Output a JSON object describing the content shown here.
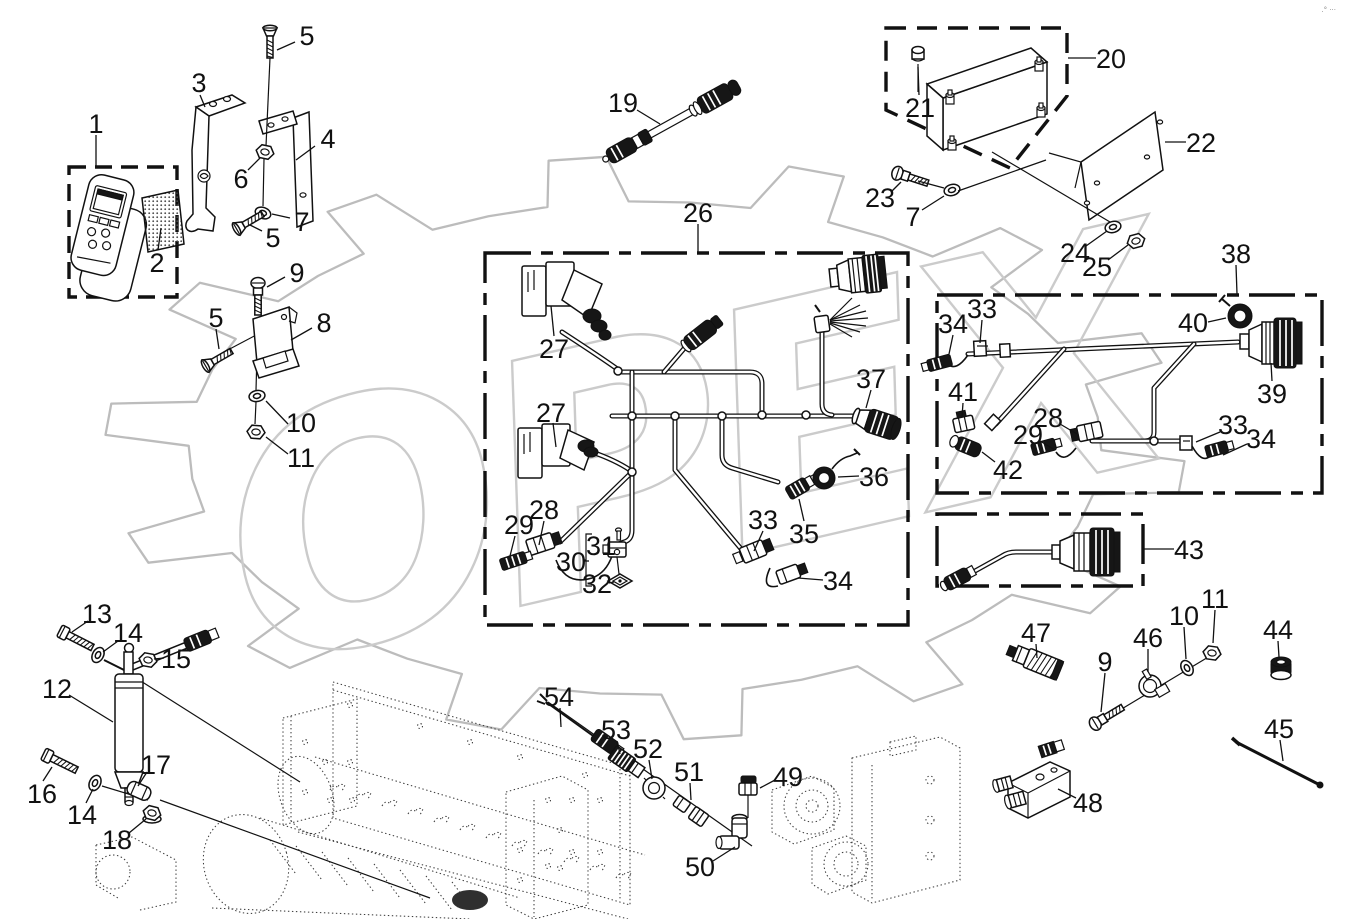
{
  "page": {
    "background": "#ffffff",
    "line_color": "#111111",
    "watermark_color": "#cbcbcb",
    "gear_color": "#bcbcbc"
  },
  "watermark": {
    "text": "OPEX"
  },
  "corner_mark": ".° ···",
  "gear": {
    "cx": 645,
    "cy": 448,
    "rx": 540,
    "ry": 292,
    "root": 0.845,
    "teeth": 14,
    "rot_rad": -0.35
  },
  "boxes": [
    {
      "name": "remote-control-box",
      "x": 69,
      "y": 167,
      "w": 108,
      "h": 130,
      "dash": "17 9"
    },
    {
      "name": "control-unit-box",
      "points": [
        [
          886,
          28
        ],
        [
          1067,
          28
        ],
        [
          1067,
          96
        ],
        [
          1010,
          168
        ],
        [
          886,
          110
        ]
      ],
      "dash": "20 11"
    },
    {
      "name": "main-harness-box",
      "x": 485,
      "y": 253,
      "w": 423,
      "h": 372,
      "dash": "46 10 12 10"
    },
    {
      "name": "harness-box-38",
      "x": 937,
      "y": 295,
      "w": 385,
      "h": 198,
      "dash": "46 10 12 10"
    },
    {
      "name": "harness-box-43",
      "x": 937,
      "y": 514,
      "w": 206,
      "h": 72,
      "dash": "40 10 12 10"
    }
  ],
  "callouts": [
    {
      "t": "1",
      "x": 96,
      "y": 123,
      "leader": [
        [
          96,
          135
        ],
        [
          96,
          166
        ]
      ]
    },
    {
      "t": "2",
      "x": 157,
      "y": 262,
      "leader": [
        [
          158,
          250
        ],
        [
          161,
          228
        ]
      ]
    },
    {
      "t": "3",
      "x": 199,
      "y": 82,
      "leader": [
        [
          200,
          95
        ],
        [
          205,
          107
        ]
      ]
    },
    {
      "t": "4",
      "x": 328,
      "y": 138,
      "leader": [
        [
          315,
          146
        ],
        [
          296,
          160
        ]
      ]
    },
    {
      "t": "5",
      "x": 307,
      "y": 35,
      "leader": [
        [
          295,
          42
        ],
        [
          277,
          50
        ]
      ]
    },
    {
      "t": "5",
      "x": 273,
      "y": 237,
      "leader": [
        [
          262,
          231
        ],
        [
          250,
          225
        ]
      ]
    },
    {
      "t": "5",
      "x": 216,
      "y": 317,
      "leader": [
        [
          216,
          329
        ],
        [
          219,
          349
        ]
      ]
    },
    {
      "t": "6",
      "x": 241,
      "y": 178,
      "leader": [
        [
          248,
          170
        ],
        [
          260,
          158
        ]
      ]
    },
    {
      "t": "7",
      "x": 302,
      "y": 221,
      "leader": [
        [
          290,
          218
        ],
        [
          272,
          214
        ]
      ]
    },
    {
      "t": "7",
      "x": 913,
      "y": 216,
      "leader": [
        [
          922,
          210
        ],
        [
          944,
          196
        ]
      ]
    },
    {
      "t": "8",
      "x": 324,
      "y": 322,
      "leader": [
        [
          312,
          328
        ],
        [
          291,
          340
        ]
      ]
    },
    {
      "t": "9",
      "x": 297,
      "y": 272,
      "leader": [
        [
          285,
          277
        ],
        [
          267,
          287
        ]
      ]
    },
    {
      "t": "9",
      "x": 1105,
      "y": 661,
      "leader": [
        [
          1105,
          673
        ],
        [
          1101,
          712
        ]
      ]
    },
    {
      "t": "10",
      "x": 301,
      "y": 422,
      "leader": [
        [
          288,
          424
        ],
        [
          266,
          401
        ]
      ]
    },
    {
      "t": "10",
      "x": 1184,
      "y": 615,
      "leader": [
        [
          1184,
          627
        ],
        [
          1186,
          659
        ]
      ]
    },
    {
      "t": "11",
      "x": 301,
      "y": 457,
      "leader": [
        [
          288,
          454
        ],
        [
          266,
          437
        ]
      ]
    },
    {
      "t": "11",
      "x": 1215,
      "y": 598,
      "leader": [
        [
          1215,
          610
        ],
        [
          1213,
          643
        ]
      ]
    },
    {
      "t": "12",
      "x": 57,
      "y": 688,
      "leader": [
        [
          69,
          695
        ],
        [
          113,
          722
        ]
      ]
    },
    {
      "t": "13",
      "x": 97,
      "y": 613,
      "leader": [
        [
          88,
          621
        ],
        [
          72,
          632
        ]
      ]
    },
    {
      "t": "14",
      "x": 128,
      "y": 632,
      "leader": [
        [
          118,
          641
        ],
        [
          103,
          652
        ]
      ]
    },
    {
      "t": "14",
      "x": 82,
      "y": 814,
      "leader": [
        [
          86,
          803
        ],
        [
          93,
          789
        ]
      ]
    },
    {
      "t": "15",
      "x": 176,
      "y": 658,
      "leader": [
        [
          164,
          658
        ],
        [
          154,
          659
        ]
      ]
    },
    {
      "t": "16",
      "x": 42,
      "y": 793,
      "leader": [
        [
          43,
          781
        ],
        [
          52,
          767
        ]
      ]
    },
    {
      "t": "17",
      "x": 156,
      "y": 764,
      "leader": [
        [
          147,
          772
        ],
        [
          138,
          786
        ]
      ]
    },
    {
      "t": "18",
      "x": 117,
      "y": 839,
      "leader": [
        [
          129,
          833
        ],
        [
          146,
          819
        ]
      ]
    },
    {
      "t": "19",
      "x": 623,
      "y": 102,
      "leader": [
        [
          637,
          110
        ],
        [
          660,
          124
        ]
      ]
    },
    {
      "t": "20",
      "x": 1111,
      "y": 58,
      "leader": [
        [
          1096,
          58
        ],
        [
          1068,
          58
        ]
      ]
    },
    {
      "t": "21",
      "x": 920,
      "y": 107,
      "leader": [
        [
          919,
          95
        ],
        [
          918,
          67
        ]
      ]
    },
    {
      "t": "22",
      "x": 1201,
      "y": 142,
      "leader": [
        [
          1186,
          142
        ],
        [
          1165,
          142
        ]
      ]
    },
    {
      "t": "23",
      "x": 880,
      "y": 197,
      "leader": [
        [
          891,
          192
        ],
        [
          901,
          182
        ]
      ]
    },
    {
      "t": "24",
      "x": 1075,
      "y": 252,
      "leader": [
        [
          1086,
          246
        ],
        [
          1107,
          231
        ]
      ]
    },
    {
      "t": "25",
      "x": 1097,
      "y": 266,
      "leader": [
        [
          1108,
          260
        ],
        [
          1128,
          245
        ]
      ]
    },
    {
      "t": "26",
      "x": 698,
      "y": 212,
      "leader": [
        [
          698,
          224
        ],
        [
          698,
          252
        ]
      ]
    },
    {
      "t": "27",
      "x": 554,
      "y": 348,
      "leader": [
        [
          554,
          336
        ],
        [
          551,
          306
        ]
      ]
    },
    {
      "t": "27",
      "x": 551,
      "y": 412,
      "leader": [
        [
          553,
          423
        ],
        [
          556,
          447
        ]
      ]
    },
    {
      "t": "28",
      "x": 544,
      "y": 509,
      "leader": [
        [
          544,
          521
        ],
        [
          539,
          545
        ]
      ]
    },
    {
      "t": "28",
      "x": 1048,
      "y": 417,
      "leader": [
        [
          1060,
          424
        ],
        [
          1077,
          434
        ]
      ]
    },
    {
      "t": "29",
      "x": 519,
      "y": 524,
      "leader": [
        [
          515,
          536
        ],
        [
          510,
          556
        ]
      ]
    },
    {
      "t": "29",
      "x": 1028,
      "y": 434,
      "leader": [
        [
          1040,
          441
        ],
        [
          1055,
          450
        ]
      ]
    },
    {
      "t": "30",
      "x": 571,
      "y": 561,
      "leader": [
        [
          583,
          561
        ],
        [
          589,
          561
        ]
      ]
    },
    {
      "t": "31",
      "x": 601,
      "y": 545
    },
    {
      "t": "32",
      "x": 597,
      "y": 583,
      "leader": [
        [
          609,
          583
        ],
        [
          614,
          582
        ]
      ]
    },
    {
      "t": "33",
      "x": 763,
      "y": 519,
      "leader": [
        [
          763,
          531
        ],
        [
          754,
          551
        ]
      ]
    },
    {
      "t": "33",
      "x": 982,
      "y": 308,
      "leader": [
        [
          982,
          320
        ],
        [
          980,
          343
        ]
      ]
    },
    {
      "t": "33",
      "x": 1233,
      "y": 424,
      "leader": [
        [
          1220,
          432
        ],
        [
          1196,
          442
        ]
      ]
    },
    {
      "t": "34",
      "x": 838,
      "y": 580,
      "leader": [
        [
          823,
          580
        ],
        [
          798,
          578
        ]
      ]
    },
    {
      "t": "34",
      "x": 953,
      "y": 323,
      "leader": [
        [
          953,
          335
        ],
        [
          949,
          354
        ]
      ]
    },
    {
      "t": "34",
      "x": 1261,
      "y": 438,
      "leader": [
        [
          1247,
          444
        ],
        [
          1223,
          455
        ]
      ]
    },
    {
      "t": "35",
      "x": 804,
      "y": 533,
      "leader": [
        [
          804,
          521
        ],
        [
          799,
          499
        ]
      ]
    },
    {
      "t": "36",
      "x": 874,
      "y": 476,
      "leader": [
        [
          859,
          476
        ],
        [
          838,
          477
        ]
      ]
    },
    {
      "t": "37",
      "x": 871,
      "y": 378,
      "leader": [
        [
          871,
          390
        ],
        [
          866,
          408
        ]
      ]
    },
    {
      "t": "38",
      "x": 1236,
      "y": 253,
      "leader": [
        [
          1236,
          265
        ],
        [
          1237,
          294
        ]
      ]
    },
    {
      "t": "39",
      "x": 1272,
      "y": 393,
      "leader": [
        [
          1272,
          381
        ],
        [
          1271,
          363
        ]
      ]
    },
    {
      "t": "40",
      "x": 1193,
      "y": 322,
      "leader": [
        [
          1208,
          322
        ],
        [
          1226,
          318
        ]
      ]
    },
    {
      "t": "41",
      "x": 963,
      "y": 391,
      "leader": [
        [
          963,
          403
        ],
        [
          962,
          417
        ]
      ]
    },
    {
      "t": "42",
      "x": 1008,
      "y": 469,
      "leader": [
        [
          995,
          462
        ],
        [
          982,
          452
        ]
      ]
    },
    {
      "t": "43",
      "x": 1189,
      "y": 549,
      "leader": [
        [
          1174,
          549
        ],
        [
          1144,
          549
        ]
      ]
    },
    {
      "t": "44",
      "x": 1278,
      "y": 629,
      "leader": [
        [
          1278,
          641
        ],
        [
          1279,
          657
        ]
      ]
    },
    {
      "t": "45",
      "x": 1279,
      "y": 728,
      "leader": [
        [
          1280,
          740
        ],
        [
          1283,
          761
        ]
      ]
    },
    {
      "t": "46",
      "x": 1148,
      "y": 637,
      "leader": [
        [
          1148,
          649
        ],
        [
          1148,
          672
        ]
      ]
    },
    {
      "t": "47",
      "x": 1036,
      "y": 632,
      "leader": [
        [
          1036,
          644
        ],
        [
          1037,
          658
        ]
      ]
    },
    {
      "t": "48",
      "x": 1088,
      "y": 802,
      "leader": [
        [
          1076,
          798
        ],
        [
          1058,
          789
        ]
      ]
    },
    {
      "t": "49",
      "x": 788,
      "y": 776,
      "leader": [
        [
          775,
          780
        ],
        [
          760,
          788
        ]
      ]
    },
    {
      "t": "50",
      "x": 700,
      "y": 866,
      "leader": [
        [
          713,
          861
        ],
        [
          735,
          847
        ]
      ]
    },
    {
      "t": "51",
      "x": 689,
      "y": 771,
      "leader": [
        [
          690,
          783
        ],
        [
          691,
          800
        ]
      ]
    },
    {
      "t": "52",
      "x": 648,
      "y": 748,
      "leader": [
        [
          649,
          760
        ],
        [
          652,
          779
        ]
      ]
    },
    {
      "t": "53",
      "x": 616,
      "y": 729,
      "leader": [
        [
          617,
          741
        ],
        [
          620,
          754
        ]
      ]
    },
    {
      "t": "54",
      "x": 559,
      "y": 696,
      "leader": [
        [
          560,
          708
        ],
        [
          561,
          727
        ]
      ]
    }
  ]
}
